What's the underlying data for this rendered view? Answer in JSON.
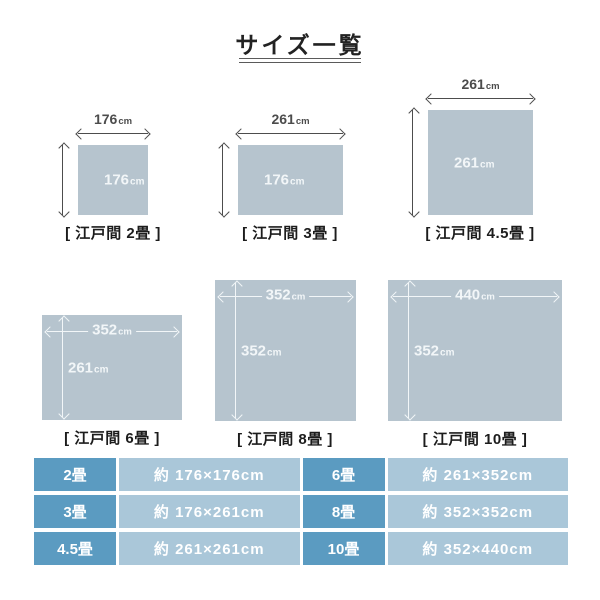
{
  "title": "サイズ一覧",
  "diagrams": [
    {
      "label": "[ 江戸間 2畳 ]",
      "width_num": "176",
      "height_num": "176",
      "unit": "cm"
    },
    {
      "label": "[ 江戸間 3畳 ]",
      "width_num": "261",
      "height_num": "176",
      "unit": "cm"
    },
    {
      "label": "[ 江戸間 4.5畳 ]",
      "width_num": "261",
      "height_num": "261",
      "unit": "cm"
    },
    {
      "label": "[ 江戸間 6畳 ]",
      "width_num": "352",
      "height_num": "261",
      "unit": "cm"
    },
    {
      "label": "[ 江戸間 8畳 ]",
      "width_num": "352",
      "height_num": "352",
      "unit": "cm"
    },
    {
      "label": "[ 江戸間 10畳 ]",
      "width_num": "440",
      "height_num": "352",
      "unit": "cm"
    }
  ],
  "size_table": {
    "rows": [
      {
        "size_left": "2畳",
        "dim_left": "約 176×176cm",
        "size_right": "6畳",
        "dim_right": "約 261×352cm"
      },
      {
        "size_left": "3畳",
        "dim_left": "約 176×261cm",
        "size_right": "8畳",
        "dim_right": "約 352×352cm"
      },
      {
        "size_left": "4.5畳",
        "dim_left": "約 261×261cm",
        "size_right": "10畳",
        "dim_right": "約 352×440cm"
      }
    ]
  },
  "colors": {
    "shape_fill": "#b6c4ce",
    "arrow_dark": "#4d4d4d",
    "table_size_bg": "#5b9bc1",
    "table_dim_bg": "#aac7d9",
    "white_text": "#ffffff"
  }
}
